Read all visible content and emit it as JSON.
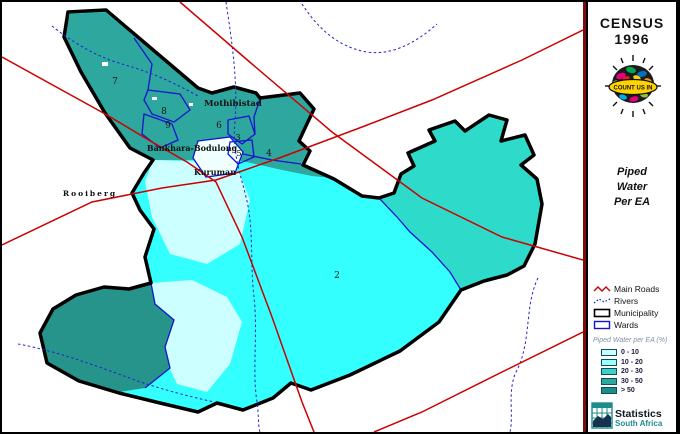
{
  "panel": {
    "census_line1": "CENSUS",
    "census_line2": "1996",
    "count_us_in": "COUNT US IN",
    "map_title_line1": "Piped",
    "map_title_line2": "Water",
    "map_title_line3": "Per EA",
    "legend1": {
      "items": [
        {
          "label": "Main Roads"
        },
        {
          "label": "Rivers"
        },
        {
          "label": "Municipality"
        },
        {
          "label": "Wards"
        }
      ]
    },
    "legend2": {
      "title": "Piped Water per EA (%)",
      "classes": [
        {
          "label": "0 - 10",
          "color": "#ccffff"
        },
        {
          "label": "10 - 20",
          "color": "#99ffff"
        },
        {
          "label": "20 - 30",
          "color": "#3fd0cc"
        },
        {
          "label": "30 - 50",
          "color": "#2ea79e"
        },
        {
          "label": "> 50",
          "color": "#1f8c8c"
        }
      ]
    },
    "stats_logo": {
      "line1": "Statistics",
      "line2": "South Africa"
    }
  },
  "map": {
    "colors": {
      "main_road": "#cc0000",
      "river": "#2222cc",
      "ward_boundary": "#1414cc",
      "municipality_outline": "#000000",
      "fill_0_10": "#ccffff",
      "fill_10_20": "#33ffff",
      "fill_20_30": "#2edbcb",
      "fill_30_50": "#2ea79e",
      "fill_over_50": "#27948b",
      "town_fill": "#f0ffff"
    },
    "place_labels": [
      {
        "name": "Mothibistad"
      },
      {
        "name": "Bankhara-Bodulong"
      },
      {
        "name": "Kuruman"
      },
      {
        "name": "Rooiberg"
      }
    ],
    "ward_numbers": [
      {
        "n": "7"
      },
      {
        "n": "8"
      },
      {
        "n": "9"
      },
      {
        "n": "6"
      },
      {
        "n": "3"
      },
      {
        "n": "5"
      },
      {
        "n": "4"
      },
      {
        "n": "2"
      }
    ]
  }
}
